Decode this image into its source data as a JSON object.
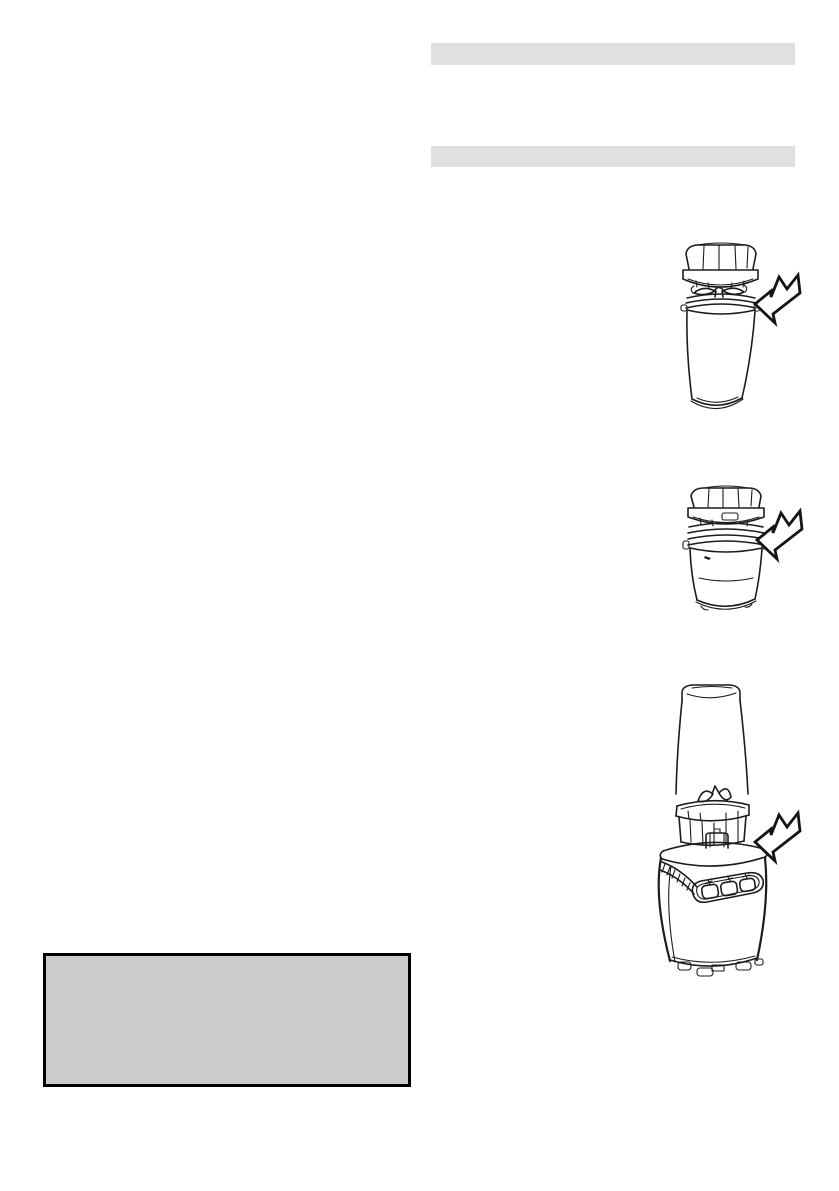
{
  "page": {
    "kind": "appliance-instruction-manual-page",
    "background_color": "#ffffff",
    "ink_color": "#1c1c1c"
  },
  "right_column": {
    "heading_bars": [
      {
        "label": "",
        "color": "#e0e0e0"
      },
      {
        "label": "",
        "color": "#e0e0e0"
      }
    ],
    "figures": [
      {
        "id": "step-1",
        "subject": "blade-lid-above-tall-blending-cup",
        "parts": [
          "blade-lid",
          "cross-blades",
          "threaded-rim",
          "tall-cup"
        ],
        "arrow": "assembly-direction-arrow"
      },
      {
        "id": "step-2",
        "subject": "blade-lid-above-short-blending-cup",
        "parts": [
          "blade-lid",
          "threaded-rim",
          "short-cup"
        ],
        "arrow": "assembly-direction-arrow"
      },
      {
        "id": "step-3",
        "subject": "inverted-cup-with-blade-ring-above-motor-base",
        "parts": [
          "inverted-cup",
          "cross-blades",
          "ribbed-blade-ring",
          "coupling-tab",
          "motor-base",
          "three-button-control-panel",
          "base-feet"
        ],
        "arrow": "assembly-direction-arrow"
      }
    ]
  },
  "note_box": {
    "text": "",
    "fill_color": "#cbcbcb",
    "border_color": "#000000"
  }
}
